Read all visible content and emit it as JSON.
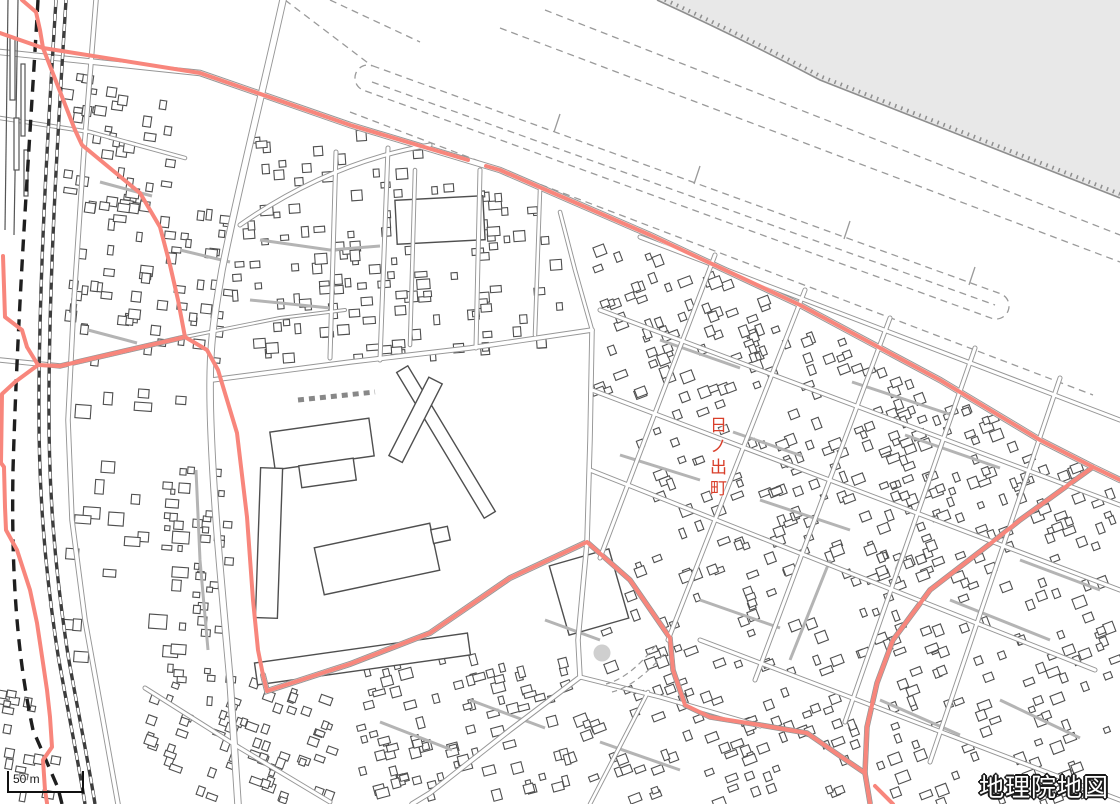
{
  "map": {
    "place_label": "日ノ出町",
    "scale_label": "50 m",
    "attribution": "地理院地図",
    "colors": {
      "background": "#ffffff",
      "water_fill": "#e8e8e8",
      "bank_line": "#8f8f8f",
      "building_outline": "#4f4f4f",
      "building_fill": "#ffffff",
      "road_casing": "#969696",
      "road_fill": "#ffffff",
      "street_gray": "#b4b4b4",
      "levee_dash": "#9a9a9a",
      "railway_dark": "#3d3d3d",
      "admin_boundary": "#1f1f1f",
      "municipal_boundary_red": "#f8867c",
      "place_label_red": "#d93f2b",
      "pond_fill": "#cfcfcf"
    }
  }
}
